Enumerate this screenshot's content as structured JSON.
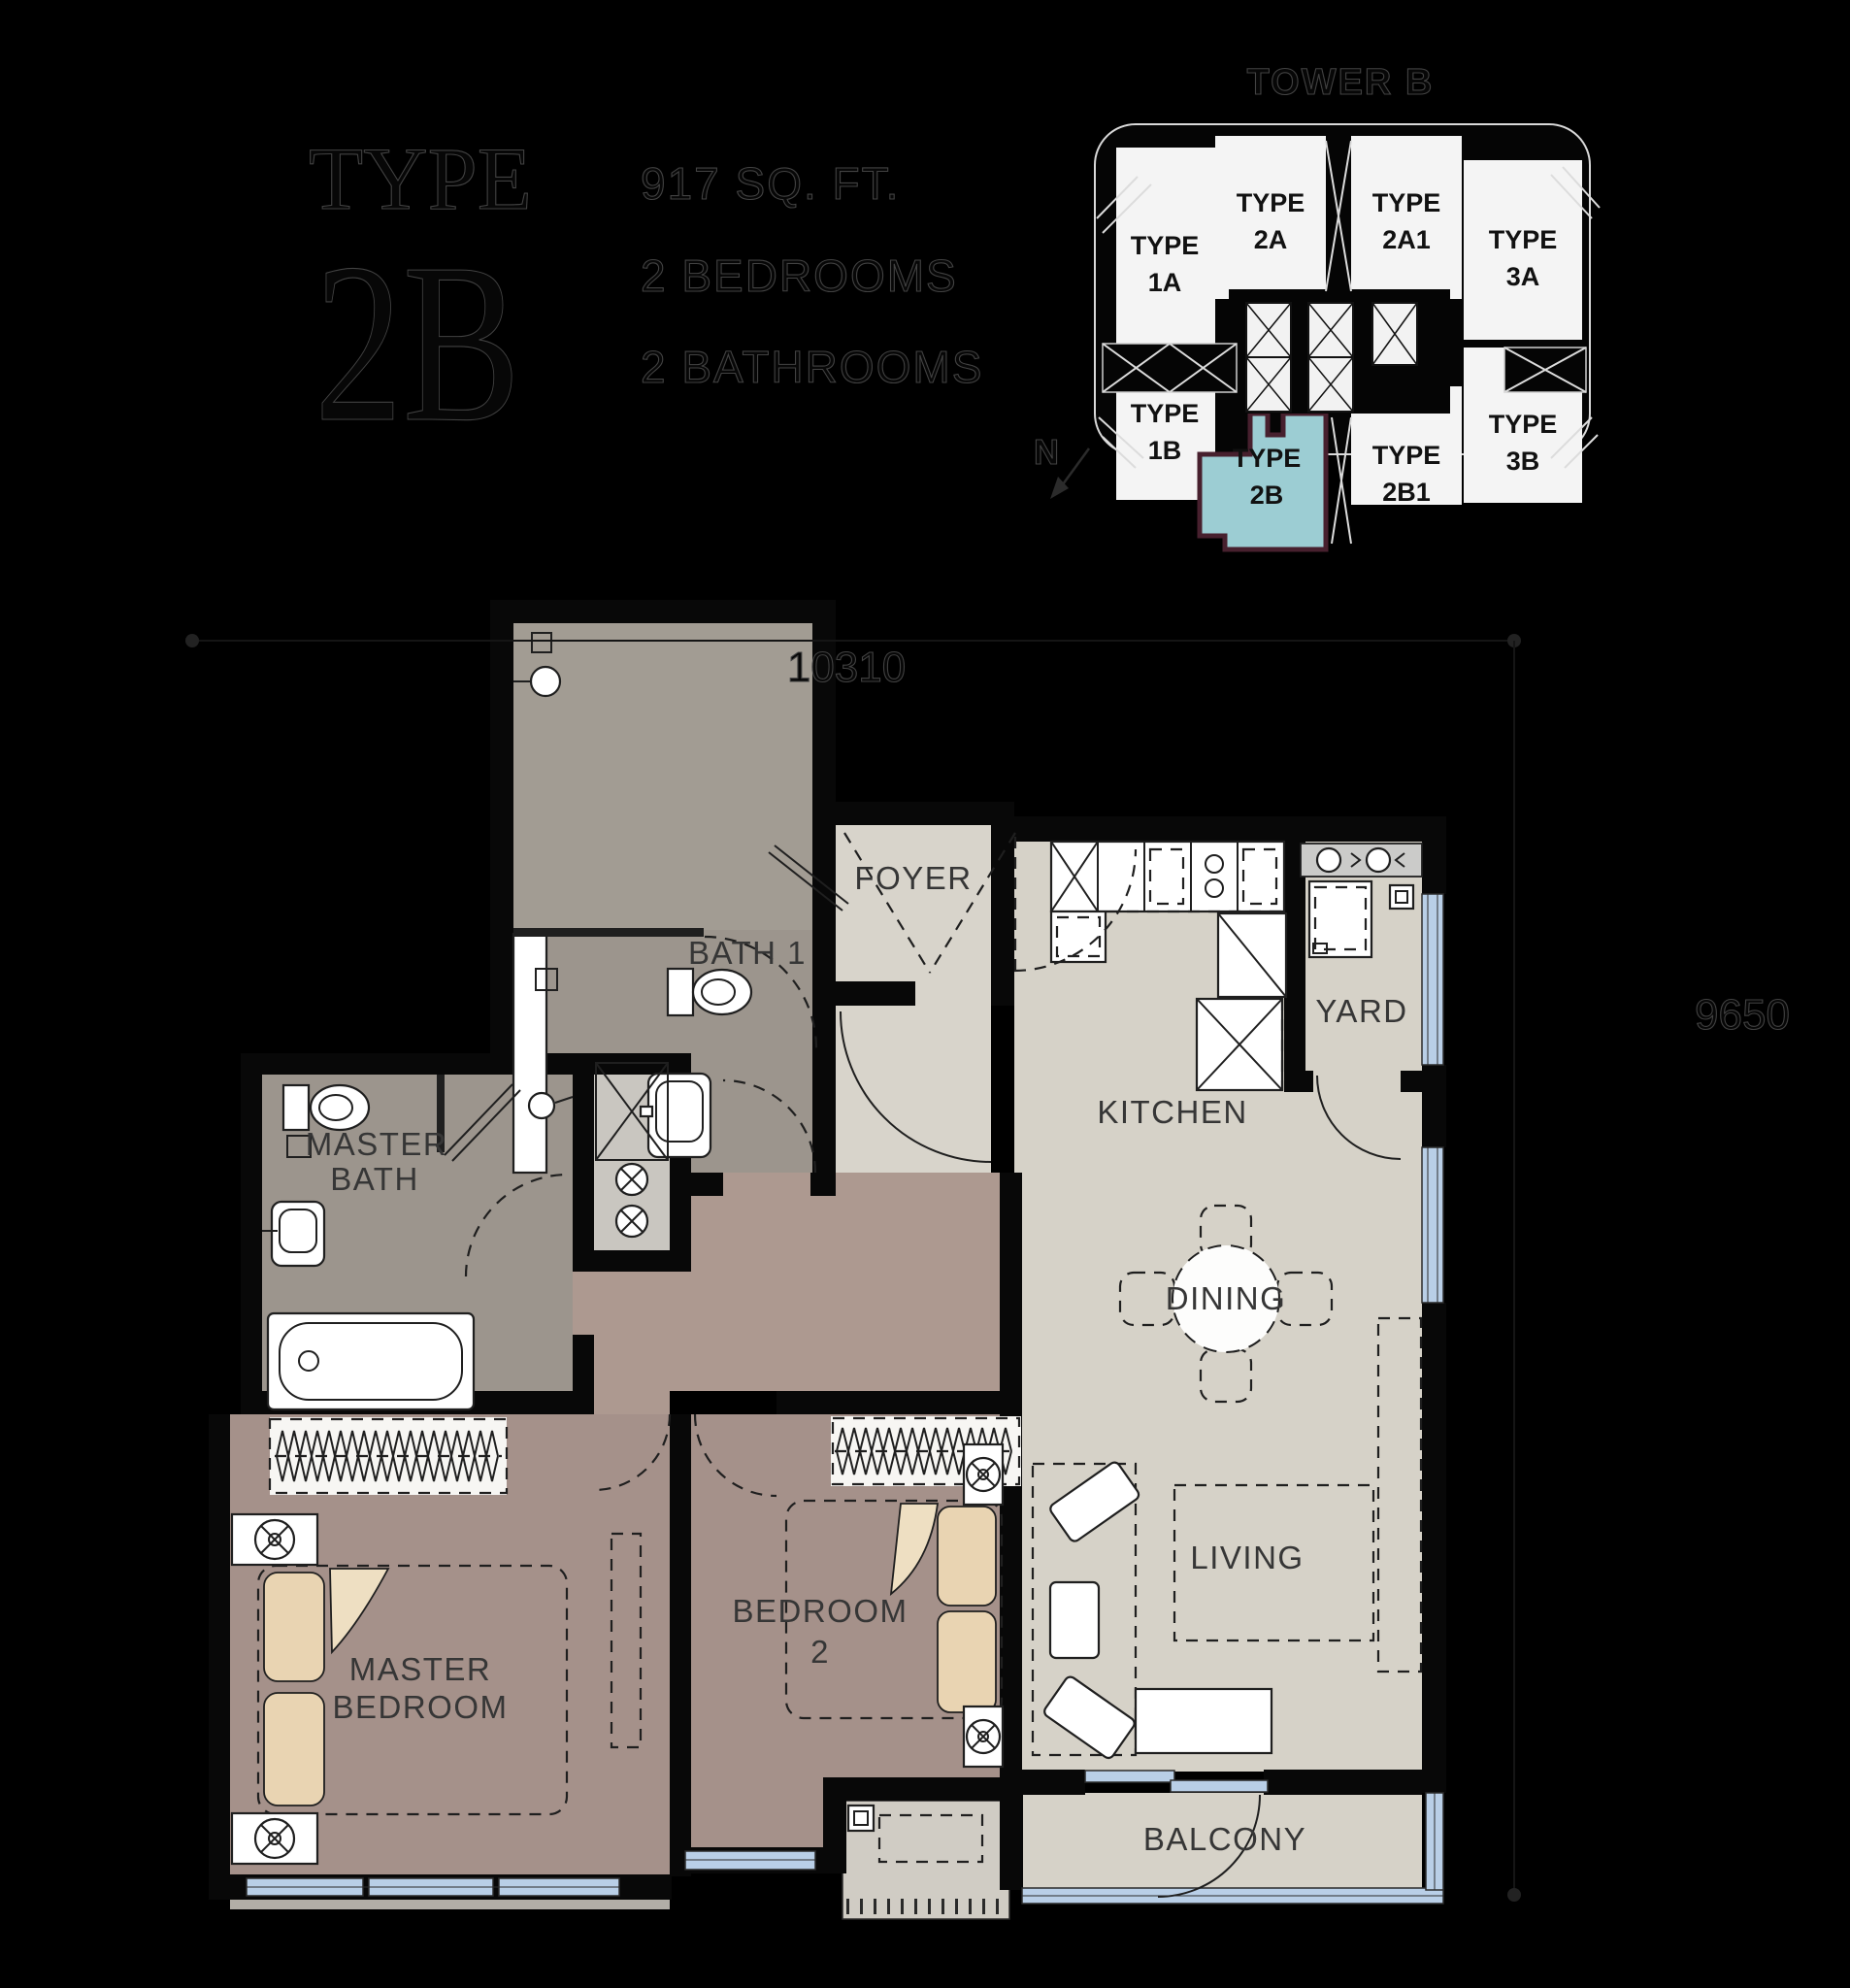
{
  "title_block": {
    "type_label": "TYPE",
    "type_value": "2B",
    "area": "917 SQ. FT.",
    "bedrooms": "2 BEDROOMS",
    "bathrooms": "2 BATHROOMS"
  },
  "key_plan": {
    "title": "TOWER B",
    "north": "N",
    "highlight_fill": "#9ccdd3",
    "highlight_border": "#47202e",
    "units": [
      {
        "id": "1A",
        "line1": "TYPE",
        "line2": "1A",
        "highlighted": false
      },
      {
        "id": "2A",
        "line1": "TYPE",
        "line2": "2A",
        "highlighted": false
      },
      {
        "id": "2A1",
        "line1": "TYPE",
        "line2": "2A1",
        "highlighted": false
      },
      {
        "id": "3A",
        "line1": "TYPE",
        "line2": "3A",
        "highlighted": false
      },
      {
        "id": "1B",
        "line1": "TYPE",
        "line2": "1B",
        "highlighted": false
      },
      {
        "id": "2B",
        "line1": "TYPE",
        "line2": "2B",
        "highlighted": true
      },
      {
        "id": "2B1",
        "line1": "TYPE",
        "line2": "2B1",
        "highlighted": false
      },
      {
        "id": "3B",
        "line1": "TYPE",
        "line2": "3B",
        "highlighted": false
      }
    ]
  },
  "floor_plan": {
    "labels": {
      "foyer": "FOYER",
      "bath1": "BATH 1",
      "kitchen": "KITCHEN",
      "yard": "YARD",
      "dining": "DINING",
      "living": "LIVING",
      "balcony": "BALCONY",
      "master_bath_line1": "MASTER",
      "master_bath_line2": "BATH",
      "master_bedroom_line1": "MASTER",
      "master_bedroom_line2": "BEDROOM",
      "bedroom2_line1": "BEDROOM",
      "bedroom2_line2": "2"
    },
    "dimensions": {
      "width_mm": "10310",
      "height_mm": "9650"
    },
    "colors": {
      "floor_light": "#d6d2c8",
      "floor_bath": "#9c958d",
      "floor_bedroom": "#a5918a",
      "floor_corridor": "#ad9990",
      "floor_ledge": "#c9c6c0",
      "window": "#b9cfe7",
      "pillow": "#e9d4b2",
      "wall": "#080808"
    }
  }
}
